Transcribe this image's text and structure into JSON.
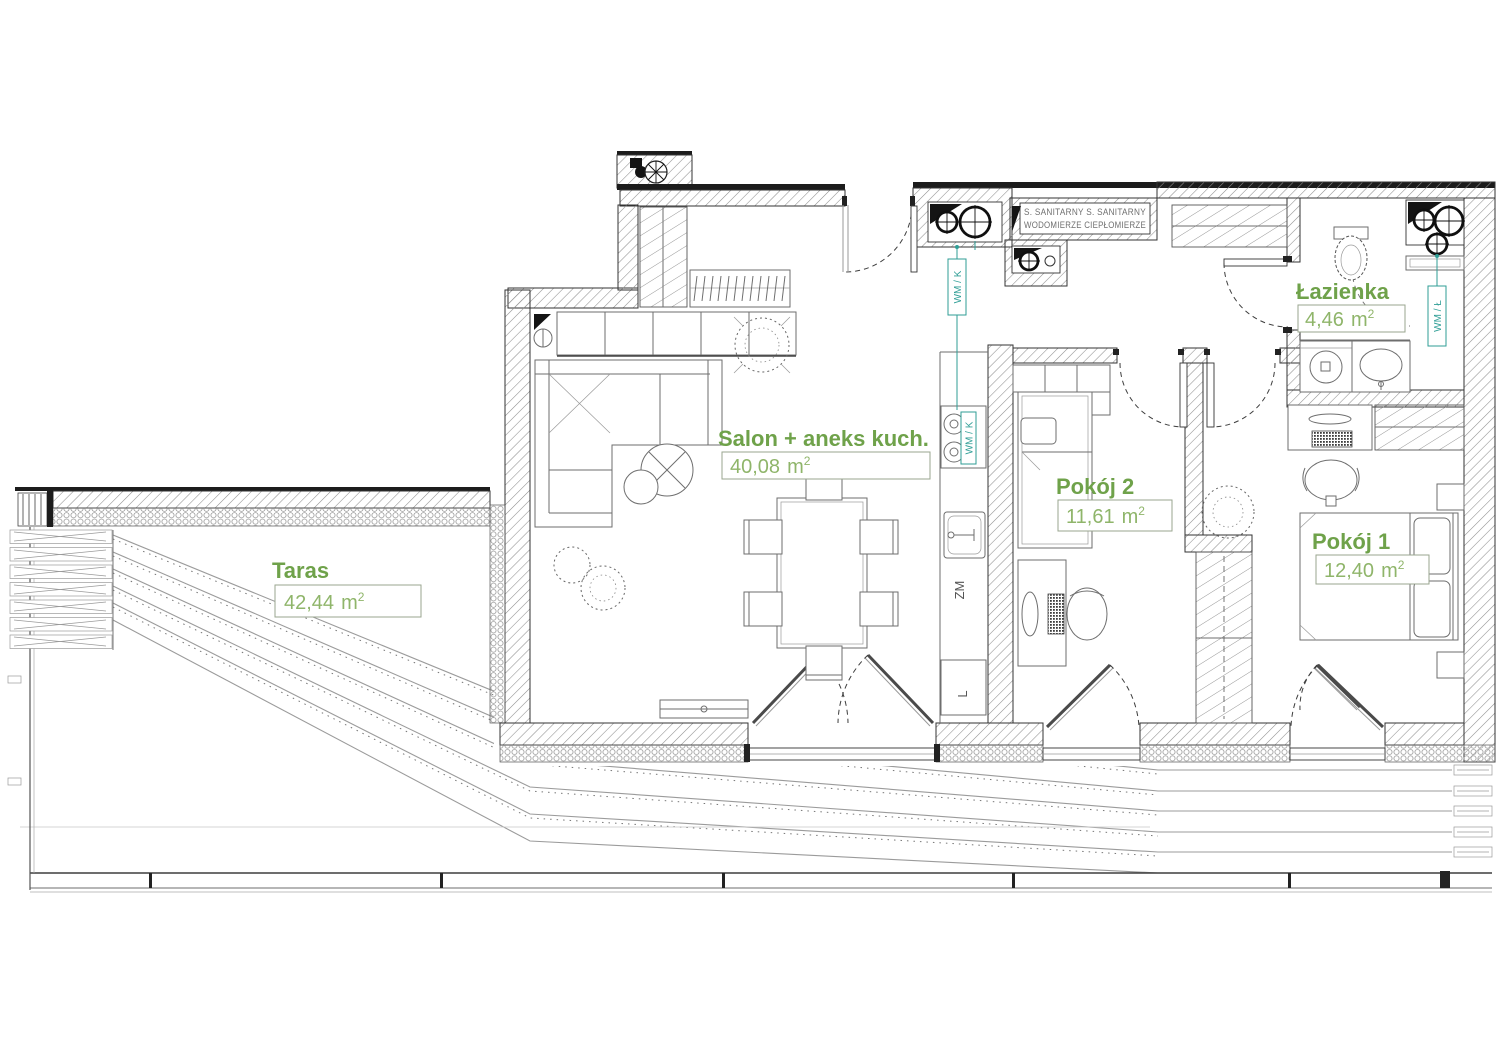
{
  "colors": {
    "room_label_title": "#6fa24a",
    "room_label_value": "#8fb56a",
    "meter_teal": "#2f9e96",
    "wall_line": "#333333",
    "background": "#ffffff"
  },
  "rooms": [
    {
      "id": "taras",
      "name": "Taras",
      "area": "42,44"
    },
    {
      "id": "salon",
      "name": "Salon + aneks kuch.",
      "area": "40,08"
    },
    {
      "id": "pokoj_2",
      "name": "Pokój 2",
      "area": "11,61"
    },
    {
      "id": "pokoj_1",
      "name": "Pokój 1",
      "area": "12,40"
    },
    {
      "id": "lazienka",
      "name": "Łazienka",
      "area": "4,46"
    }
  ],
  "units": {
    "meter": "m",
    "exponent": "2"
  },
  "labels": {
    "water_meter_kitchen": "WM / K",
    "water_meter_bathroom": "WM / Ł",
    "dishwasher": "ZM",
    "fridge": "L",
    "shaft_line1": "S. SANITARNY  S. SANITARNY",
    "shaft_line2": "WODOMIERZE CIEPŁOMIERZE"
  }
}
